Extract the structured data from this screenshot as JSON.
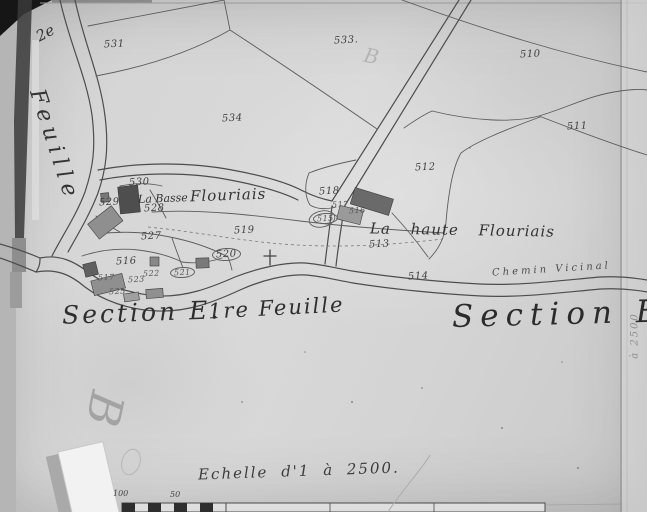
{
  "map": {
    "margin": {
      "sheet_number": "2e",
      "sheet_word": "Feuille",
      "right_note": "à 2500",
      "pencil_mark": "B",
      "watermark": "B"
    },
    "titles": {
      "section_left": "Section E.",
      "sheet_left": "1re Feuille",
      "section_right": "Section E."
    },
    "places": {
      "la_basse": "La Basse",
      "flouriais": "Flouriais",
      "la_haute": "La haute Flouriais",
      "chemin": "Chemin Vicinal"
    },
    "scale": {
      "caption": "Echelle d'1 à 2500.",
      "tick_100": "100",
      "tick_50": "50"
    },
    "parcels": [
      {
        "n": "531"
      },
      {
        "n": "533."
      },
      {
        "n": "510"
      },
      {
        "n": "534"
      },
      {
        "n": "511"
      },
      {
        "n": "512"
      },
      {
        "n": "518"
      },
      {
        "n": "530"
      },
      {
        "n": "529"
      },
      {
        "n": "528"
      },
      {
        "n": "517"
      },
      {
        "n": "516"
      },
      {
        "n": "515"
      },
      {
        "n": "519"
      },
      {
        "n": "527"
      },
      {
        "n": "513"
      },
      {
        "n": "520"
      },
      {
        "n": "516"
      },
      {
        "n": "521"
      },
      {
        "n": "522"
      },
      {
        "n": "517"
      },
      {
        "n": "523"
      },
      {
        "n": "525"
      },
      {
        "n": "514"
      }
    ]
  }
}
